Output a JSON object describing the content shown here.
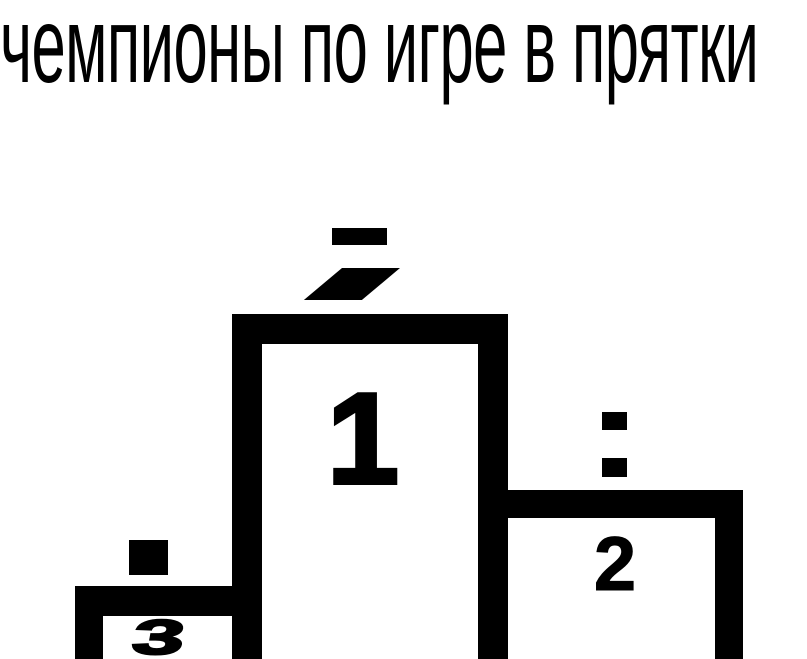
{
  "title": "чемпионы по игре в прятки",
  "podium": {
    "first": {
      "rank": "1"
    },
    "second": {
      "rank": "2"
    },
    "third": {
      "rank": "3"
    }
  },
  "hidden_champions": {
    "first_marks": [
      "hat-dash",
      "slanted-visor"
    ],
    "second_marks": [
      "eye-dot-top",
      "eye-dot-bottom"
    ],
    "third_marks": [
      "head-square"
    ]
  },
  "colors": {
    "ink": "#000000",
    "background": "#ffffff"
  }
}
